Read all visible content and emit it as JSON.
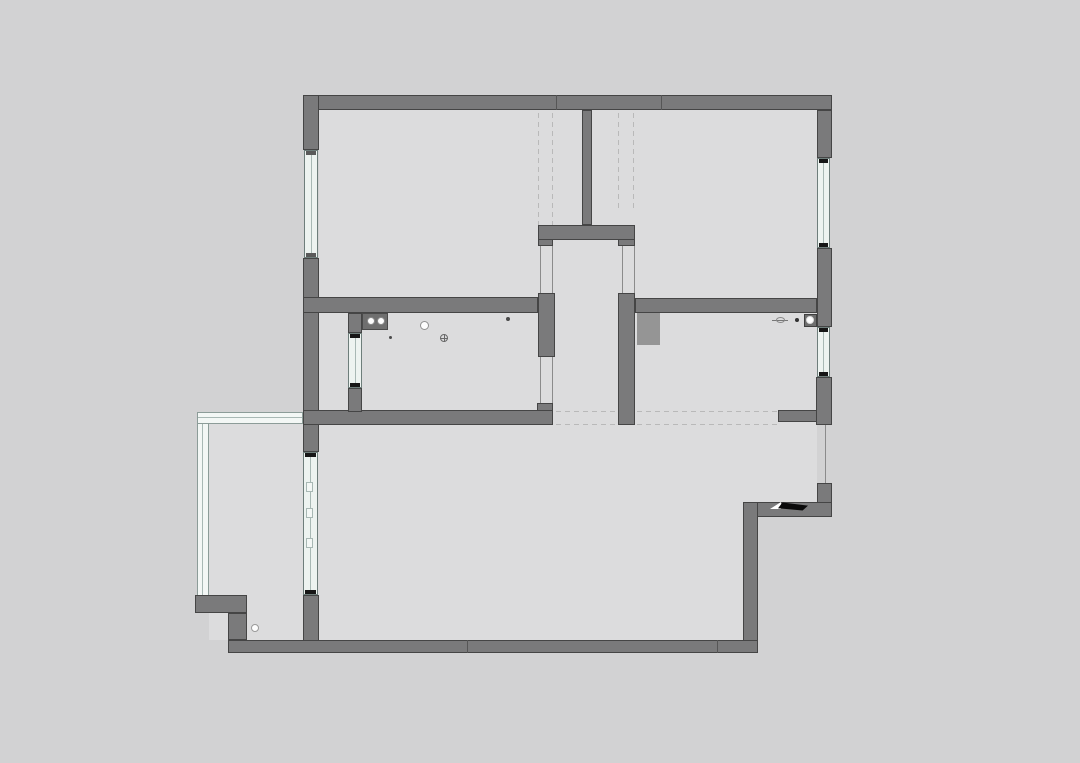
{
  "canvas": {
    "w": 1080,
    "h": 763,
    "bg": "#d2d2d3"
  },
  "colors": {
    "room_fill": "#dcdcdd",
    "wall_fill": "#7a7a7b",
    "wall_edge": "#454545",
    "duct_fill": "#959595",
    "window_fill": "#edf3f0",
    "window_line": "#a8b8b4",
    "glazing_fill": "#f3f7f5",
    "dash_color": "#b9b9b9",
    "thin_line": "#8b8b8b",
    "seam_color": "#565656",
    "tick_dark": "#161616",
    "tick_gray": "#5a5a5a",
    "fixture_dark": "#6f6f6f",
    "fixture_white": "#fdfdfd",
    "mat_black": "#0a0a0a"
  },
  "rooms": [
    {
      "name": "bedroom-1-floor",
      "x": 319,
      "y": 110,
      "w": 219,
      "h": 187
    },
    {
      "name": "hallway-floor",
      "x": 538,
      "y": 110,
      "w": 97,
      "h": 115
    },
    {
      "name": "corridor-floor",
      "x": 538,
      "y": 240,
      "w": 97,
      "h": 172
    },
    {
      "name": "bedroom-2-floor",
      "x": 635,
      "y": 110,
      "w": 182,
      "h": 188
    },
    {
      "name": "light-well-floor",
      "x": 319,
      "y": 313,
      "w": 29,
      "h": 97
    },
    {
      "name": "kitchen-floor",
      "x": 348,
      "y": 313,
      "w": 190,
      "h": 97
    },
    {
      "name": "bathroom-floor",
      "x": 635,
      "y": 313,
      "w": 182,
      "h": 112
    },
    {
      "name": "gap-floor",
      "x": 538,
      "y": 403,
      "w": 97,
      "h": 22
    },
    {
      "name": "living-room-floor",
      "x": 303,
      "y": 425,
      "w": 455,
      "h": 215
    },
    {
      "name": "entry-floor",
      "x": 635,
      "y": 425,
      "w": 182,
      "h": 77
    },
    {
      "name": "balcony-floor",
      "x": 209,
      "y": 424,
      "w": 94,
      "h": 216
    }
  ],
  "walls": [
    {
      "name": "top-exterior-wall",
      "x": 303,
      "y": 95,
      "w": 529,
      "h": 15
    },
    {
      "name": "left-wall-upper",
      "x": 303,
      "y": 95,
      "w": 16,
      "h": 55
    },
    {
      "name": "left-wall-mid",
      "x": 303,
      "y": 258,
      "w": 16,
      "h": 155
    },
    {
      "name": "left-pillar",
      "x": 303,
      "y": 413,
      "w": 16,
      "h": 39
    },
    {
      "name": "balcony-door-stub",
      "x": 303,
      "y": 595,
      "w": 16,
      "h": 58
    },
    {
      "name": "bedroom1-south-wall",
      "x": 303,
      "y": 297,
      "w": 235,
      "h": 16
    },
    {
      "name": "kitchen-east-stub",
      "x": 538,
      "y": 293,
      "w": 17,
      "h": 64
    },
    {
      "name": "kitchen-south-wall",
      "x": 303,
      "y": 410,
      "w": 250,
      "h": 15
    },
    {
      "name": "kitchen-door-notch",
      "x": 537,
      "y": 403,
      "w": 16,
      "h": 8
    },
    {
      "name": "kitchen-west-wall-top",
      "x": 348,
      "y": 313,
      "w": 14,
      "h": 20
    },
    {
      "name": "kitchen-west-wall-bottom",
      "x": 348,
      "y": 388,
      "w": 14,
      "h": 24
    },
    {
      "name": "hall-partition-wall",
      "x": 582,
      "y": 110,
      "w": 10,
      "h": 115
    },
    {
      "name": "hall-south-wall",
      "x": 538,
      "y": 225,
      "w": 97,
      "h": 15
    },
    {
      "name": "bedroom2-south-wall",
      "x": 635,
      "y": 298,
      "w": 182,
      "h": 15
    },
    {
      "name": "bathroom-west-wall",
      "x": 618,
      "y": 293,
      "w": 17,
      "h": 132
    },
    {
      "name": "right-wall-upper",
      "x": 817,
      "y": 110,
      "w": 15,
      "h": 48
    },
    {
      "name": "right-wall-mid",
      "x": 817,
      "y": 248,
      "w": 15,
      "h": 79
    },
    {
      "name": "right-wall-lower",
      "x": 816,
      "y": 377,
      "w": 16,
      "h": 48
    },
    {
      "name": "entry-north-stub",
      "x": 778,
      "y": 410,
      "w": 39,
      "h": 12
    },
    {
      "name": "entry-east-wall",
      "x": 817,
      "y": 483,
      "w": 15,
      "h": 34
    },
    {
      "name": "entry-south-wall",
      "x": 743,
      "y": 502,
      "w": 89,
      "h": 15
    },
    {
      "name": "living-east-wall",
      "x": 743,
      "y": 502,
      "w": 15,
      "h": 151
    },
    {
      "name": "bottom-exterior-wall",
      "x": 228,
      "y": 640,
      "w": 530,
      "h": 13
    },
    {
      "name": "balcony-step-wall-h",
      "x": 195,
      "y": 595,
      "w": 52,
      "h": 18
    },
    {
      "name": "balcony-step-wall-v",
      "x": 228,
      "y": 613,
      "w": 19,
      "h": 27
    }
  ],
  "tabs": [
    {
      "name": "hall-door-jamb-left",
      "x": 538,
      "y": 240,
      "w": 15,
      "h": 6
    },
    {
      "name": "hall-door-jamb-right",
      "x": 618,
      "y": 240,
      "w": 17,
      "h": 6
    }
  ],
  "duct": {
    "name": "pipe-duct-block",
    "x": 637,
    "y": 313,
    "w": 23,
    "h": 32
  },
  "windows": [
    {
      "name": "bedroom1-west-window",
      "x": 304,
      "y": 150,
      "w": 14,
      "h": 108,
      "tick": "gray"
    },
    {
      "name": "bedroom2-east-window",
      "x": 817,
      "y": 158,
      "w": 13,
      "h": 90,
      "tick": "dark"
    },
    {
      "name": "bathroom-east-window",
      "x": 817,
      "y": 327,
      "w": 13,
      "h": 50,
      "tick": "dark"
    },
    {
      "name": "kitchen-west-window",
      "x": 348,
      "y": 333,
      "w": 14,
      "h": 55,
      "tick": "dark"
    }
  ],
  "balcony_door": {
    "name": "balcony-sliding-door",
    "x": 303,
    "y": 452,
    "w": 15,
    "h": 143,
    "panel_marks": [
      30,
      56,
      86
    ]
  },
  "glazing": [
    {
      "name": "balcony-glazing-left",
      "x": 197,
      "y": 412,
      "w": 12,
      "h": 185,
      "dir": "v"
    },
    {
      "name": "balcony-glazing-top",
      "x": 197,
      "y": 412,
      "w": 106,
      "h": 12,
      "dir": "h"
    }
  ],
  "dashed_lines": [
    {
      "name": "demolished-wall-dash",
      "x": 538,
      "y": 113,
      "len": 112,
      "dir": "v"
    },
    {
      "name": "demolished-wall-dash",
      "x": 552,
      "y": 113,
      "len": 112,
      "dir": "v"
    },
    {
      "name": "demolished-wall-dash",
      "x": 618,
      "y": 113,
      "len": 99,
      "dir": "v"
    },
    {
      "name": "demolished-wall-dash",
      "x": 633,
      "y": 113,
      "len": 99,
      "dir": "v"
    },
    {
      "name": "demolished-wall-dash",
      "x": 556,
      "y": 411,
      "len": 222,
      "dir": "h"
    },
    {
      "name": "demolished-wall-dash",
      "x": 556,
      "y": 424,
      "len": 222,
      "dir": "h"
    }
  ],
  "thin_lines": [
    {
      "name": "opening-jamb-line",
      "x": 540,
      "y": 246,
      "len": 47,
      "dir": "v"
    },
    {
      "name": "opening-jamb-line",
      "x": 552,
      "y": 246,
      "len": 47,
      "dir": "v"
    },
    {
      "name": "opening-jamb-line",
      "x": 540,
      "y": 357,
      "len": 46,
      "dir": "v"
    },
    {
      "name": "opening-jamb-line",
      "x": 552,
      "y": 357,
      "len": 46,
      "dir": "v"
    },
    {
      "name": "opening-jamb-line",
      "x": 622,
      "y": 246,
      "len": 47,
      "dir": "v"
    },
    {
      "name": "opening-jamb-line",
      "x": 634,
      "y": 246,
      "len": 47,
      "dir": "v"
    },
    {
      "name": "entry-door-line",
      "x": 825,
      "y": 425,
      "len": 58,
      "dir": "v"
    }
  ],
  "seams": [
    {
      "name": "wall-joint-seam",
      "x": 556,
      "y": 95,
      "len": 15,
      "dir": "v"
    },
    {
      "name": "wall-joint-seam",
      "x": 661,
      "y": 95,
      "len": 15,
      "dir": "v"
    },
    {
      "name": "wall-joint-seam",
      "x": 467,
      "y": 640,
      "len": 13,
      "dir": "v"
    },
    {
      "name": "wall-joint-seam",
      "x": 717,
      "y": 640,
      "len": 13,
      "dir": "v"
    }
  ],
  "fixtures": [
    {
      "type": "rect",
      "name": "kitchen-sink-counter",
      "x": 362,
      "y": 313,
      "w": 26,
      "h": 17,
      "fill": "#6f6f6f",
      "edge": "#4a4a4a"
    },
    {
      "type": "circle",
      "name": "sink-basin-left",
      "cx": 371,
      "cy": 321,
      "r": 4,
      "fill": "#fdfdfd",
      "edge": "#8a8a8a"
    },
    {
      "type": "circle",
      "name": "sink-basin-right",
      "cx": 381,
      "cy": 321,
      "r": 4,
      "fill": "#fdfdfd",
      "edge": "#8a8a8a"
    },
    {
      "type": "circle",
      "name": "kitchen-lamp",
      "cx": 424,
      "cy": 325,
      "r": 4.5,
      "fill": "#fdfdfd",
      "edge": "#909090"
    },
    {
      "type": "circle",
      "name": "small-dot",
      "cx": 390,
      "cy": 337,
      "r": 1.5,
      "fill": "#4a4a4a",
      "edge": "#4a4a4a"
    },
    {
      "type": "circle",
      "name": "small-dot",
      "cx": 508,
      "cy": 319,
      "r": 2,
      "fill": "#4a4a4a",
      "edge": "#4a4a4a"
    },
    {
      "type": "drain",
      "name": "floor-drain-symbol",
      "cx": 444,
      "cy": 338,
      "r": 4,
      "edge": "#6a6a6a"
    },
    {
      "type": "faucet",
      "name": "faucet-symbol",
      "x": 772,
      "y": 320
    },
    {
      "type": "rect",
      "name": "washer-box",
      "x": 804,
      "y": 314,
      "w": 13,
      "h": 13,
      "fill": "#6e6e6e",
      "edge": "#3f3f3f"
    },
    {
      "type": "circle",
      "name": "washer-drain",
      "cx": 810,
      "cy": 320,
      "r": 4,
      "fill": "#fdfdfd",
      "edge": "#dddddd"
    },
    {
      "type": "circle",
      "name": "balcony-drain",
      "cx": 255,
      "cy": 628,
      "r": 4,
      "fill": "#fdfdfd",
      "edge": "#9a9a9a"
    },
    {
      "type": "mat",
      "name": "entry-door-mat",
      "x": 770,
      "y": 502,
      "w": 38,
      "h": 9
    }
  ]
}
